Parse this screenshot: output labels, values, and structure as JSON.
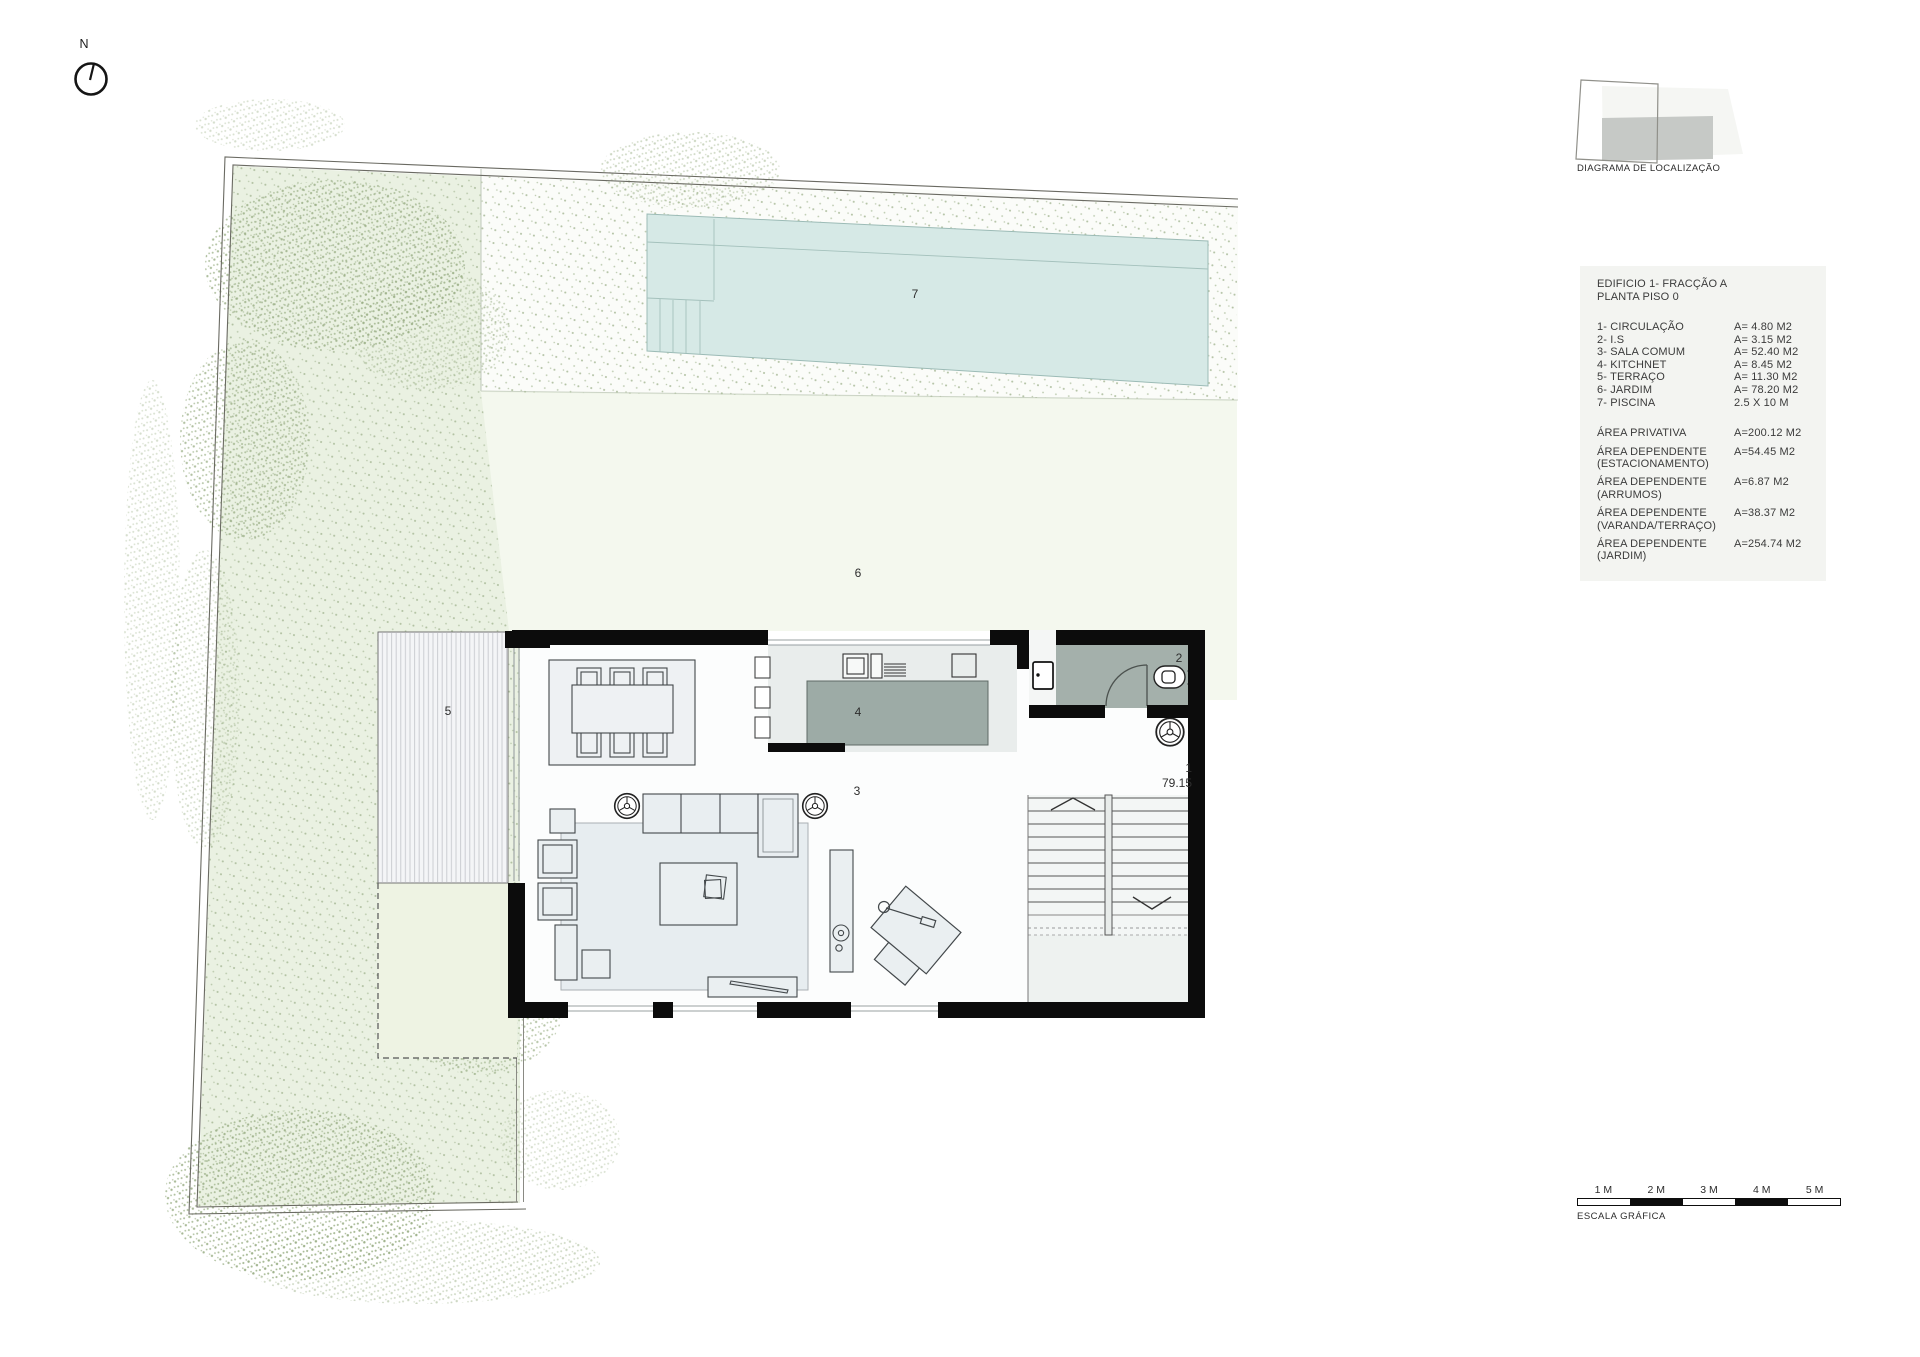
{
  "north": {
    "label": "N"
  },
  "localization": {
    "label": "DIAGRAMA DE LOCALIZAÇÃO"
  },
  "legend": {
    "title_line1": "EDIFICIO 1- FRACÇÃO A",
    "title_line2": "PLANTA PISO 0",
    "items": [
      {
        "label": "1- CIRCULAÇÃO",
        "value": "A= 4.80 M2"
      },
      {
        "label": "2- I.S",
        "value": "A= 3.15 M2"
      },
      {
        "label": "3- SALA COMUM",
        "value": "A= 52.40 M2"
      },
      {
        "label": "4- KITCHNET",
        "value": "A= 8.45 M2"
      },
      {
        "label": "5- TERRAÇO",
        "value": "A= 11.30 M2"
      },
      {
        "label": "6- JARDIM",
        "value": "A= 78.20 M2"
      },
      {
        "label": "7- PISCINA",
        "value": "2.5 X 10 M"
      }
    ],
    "areas": [
      {
        "label": "ÁREA PRIVATIVA",
        "sub": "",
        "value": "A=200.12 M2"
      },
      {
        "label": "ÁREA DEPENDENTE",
        "sub": "(ESTACIONAMENTO)",
        "value": "A=54.45 M2"
      },
      {
        "label": "ÁREA DEPENDENTE",
        "sub": "(ARRUMOS)",
        "value": "A=6.87 M2"
      },
      {
        "label": "ÁREA DEPENDENTE",
        "sub": "(VARANDA/TERRAÇO)",
        "value": "A=38.37 M2"
      },
      {
        "label": "ÁREA DEPENDENTE",
        "sub": "(JARDIM)",
        "value": "A=254.74 M2"
      }
    ]
  },
  "plan": {
    "room_1": "1",
    "room_2": "2",
    "room_3": "3",
    "room_4": "4",
    "room_5": "5",
    "room_6": "6",
    "room_7": "7",
    "level": "79.15"
  },
  "scalebar": {
    "labels": [
      "1 M",
      "2 M",
      "3 M",
      "4 M",
      "5 M"
    ],
    "caption": "ESCALA GRÁFICA"
  },
  "colors": {
    "garden": "#eaf1e2",
    "garden_light": "#f4f8ee",
    "pool": "#d6e9e6",
    "wall": "#0c0c0c",
    "island_gray": "#9dab a6"
  }
}
